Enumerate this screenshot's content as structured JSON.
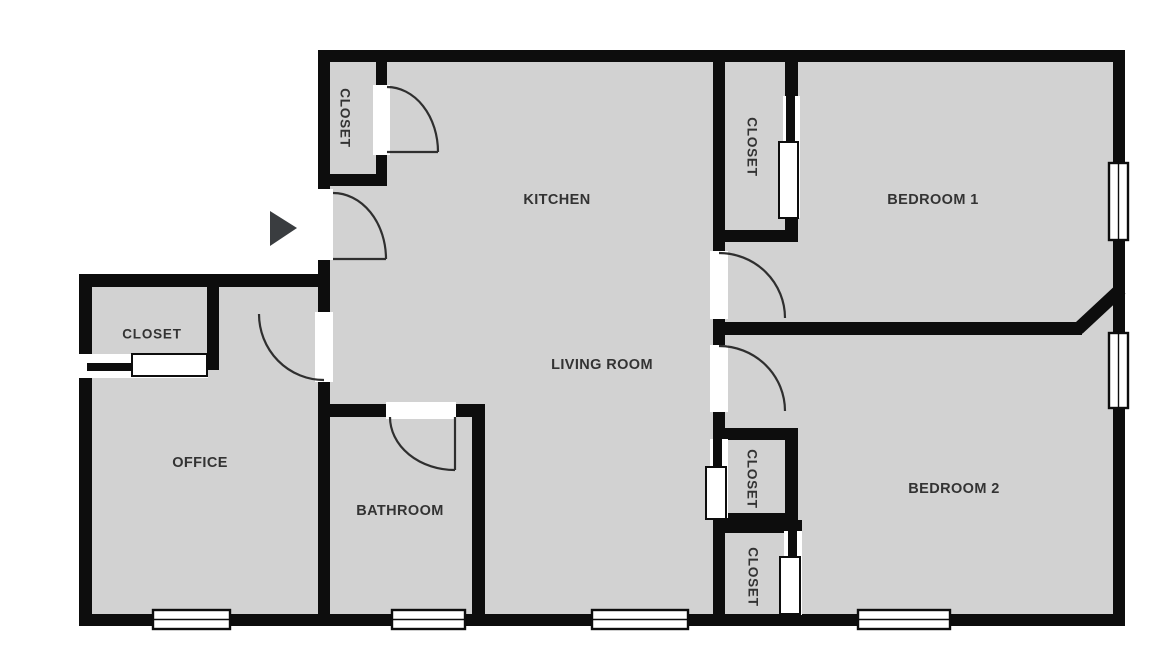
{
  "plan_type": "floor-plan",
  "colors": {
    "background": "#ffffff",
    "floor": "#d2d2d2",
    "wall": "#0d0d0d",
    "opening": "#ffffff",
    "door_arc": "#2f2f2f",
    "window_fill": "#ffffff",
    "label": "#333333",
    "arrow": "#3a3d40"
  },
  "rooms": {
    "kitchen": {
      "label": "KITCHEN"
    },
    "living_room": {
      "label": "LIVING ROOM"
    },
    "bedroom_1": {
      "label": "BEDROOM 1"
    },
    "bedroom_2": {
      "label": "BEDROOM 2"
    },
    "office": {
      "label": "OFFICE"
    },
    "bathroom": {
      "label": "BATHROOM"
    },
    "kitchen_closet": {
      "label": "CLOSET"
    },
    "bedroom_1_closet": {
      "label": "CLOSET"
    },
    "office_closet": {
      "label": "CLOSET"
    },
    "hall_closet": {
      "label": "CLOSET"
    },
    "bedroom_2_closet": {
      "label": "CLOSET"
    }
  },
  "icons": {
    "entry_arrow": "right-pointing-triangle-entry-marker"
  }
}
